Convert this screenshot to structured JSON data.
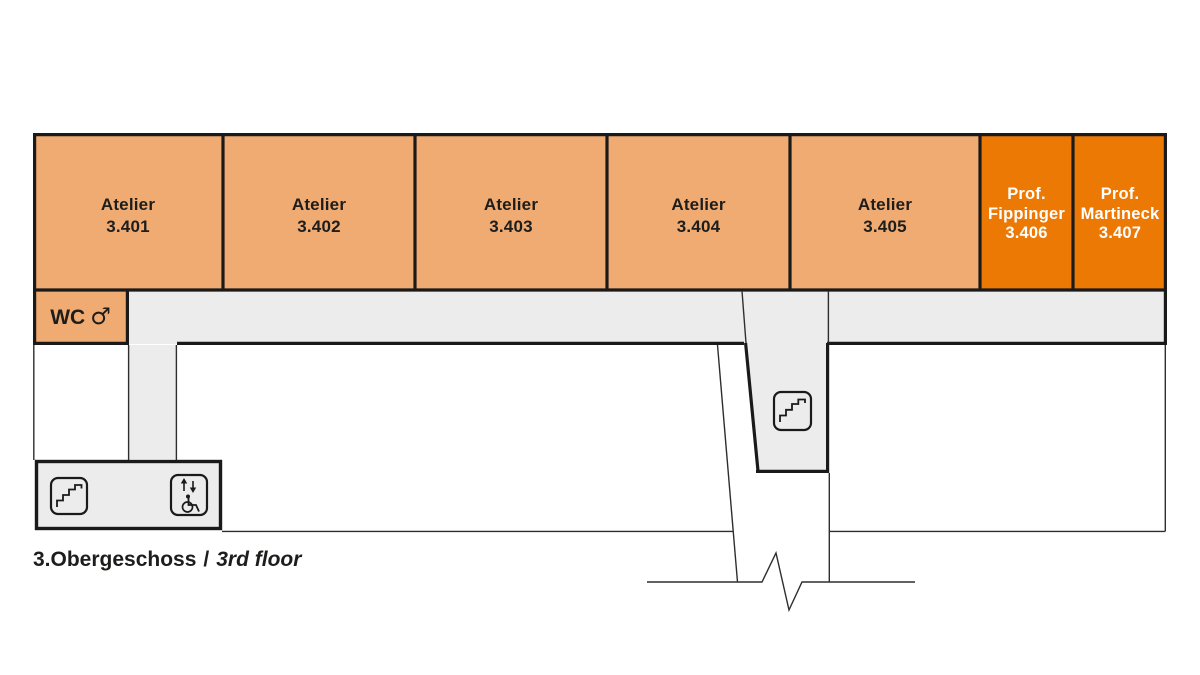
{
  "plan": {
    "rooms": [
      {
        "name": "Atelier",
        "number": "3.401"
      },
      {
        "name": "Atelier",
        "number": "3.402"
      },
      {
        "name": "Atelier",
        "number": "3.403"
      },
      {
        "name": "Atelier",
        "number": "3.404"
      },
      {
        "name": "Atelier",
        "number": "3.405"
      },
      {
        "title": "Prof.",
        "surname": "Fippinger",
        "number": "3.406"
      },
      {
        "title": "Prof.",
        "surname": "Martineck",
        "number": "3.407"
      }
    ],
    "wc": {
      "label": "WC",
      "gender_symbol": "♂"
    },
    "caption": {
      "de": "3.Obergeschoss",
      "separator": "/",
      "en": "3rd floor"
    },
    "icons": {
      "left_stairs": "stairs-icon",
      "elevator": "accessible-elevator-icon",
      "middle_stairs": "stairs-icon"
    },
    "colors": {
      "atelier_fill": "#F0AB72",
      "professor_fill": "#ED7905",
      "corridor_fill": "#ECECEC",
      "wall": "#1A1A1A",
      "label_text": "#1D1D1B",
      "professor_text": "#FFFFFF",
      "background": "#FFFFFF"
    }
  }
}
